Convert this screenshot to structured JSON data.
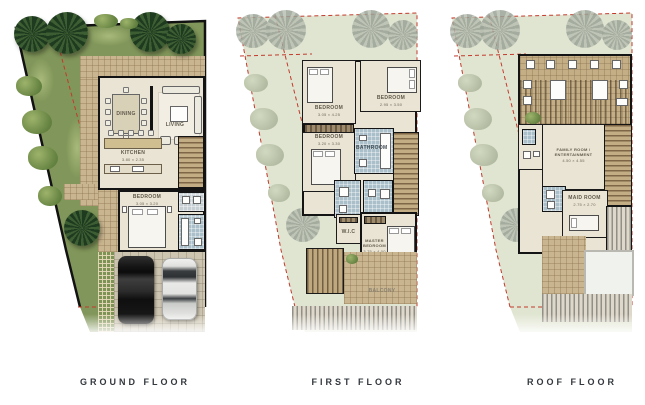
{
  "floors": [
    {
      "label": "GROUND FLOOR",
      "rooms": {
        "dining": "DINING",
        "living": "LIVING",
        "kitchen": "KITCHEN",
        "kitchen_dim": "3.80 × 2.35",
        "bedroom": "BEDROOM",
        "bedroom_dim": "3.05 × 3.20"
      }
    },
    {
      "label": "FIRST FLOOR",
      "rooms": {
        "bedroom1": "BEDROOM",
        "bedroom1_dim": "3.05 × 4.25",
        "bedroom2": "BEDROOM",
        "bedroom2_dim": "2.95 × 3.50",
        "bedroom3": "BEDROOM",
        "bedroom3_dim": "3.20 × 3.30",
        "bath": "BATHROOM",
        "master": "MASTER BEDROOM",
        "master_dim": "3.75 × 4.00",
        "wic": "W.I.C",
        "balcony": "BALCONY"
      }
    },
    {
      "label": "ROOF FLOOR",
      "rooms": {
        "family": "FAMILY ROOM / ENTERTAINMENT",
        "family_dim": "4.50 × 4.55",
        "maid": "MAID ROOM",
        "maid_dim": "2.75 × 2.70"
      }
    }
  ],
  "colors": {
    "grass": "#81965a",
    "grass_faded": "#e0e5d1",
    "paving": "#c9b58f",
    "floor": "#eae4d4",
    "wall": "#141414",
    "bath_tile": "#a9bfc9",
    "setback_line": "#c23a2c",
    "label_text": "#33383e"
  },
  "icons": {
    "palm_tree": "palm-tree-icon",
    "bush": "bush-icon",
    "black_car": "black-car-icon",
    "white_car": "white-car-icon"
  }
}
